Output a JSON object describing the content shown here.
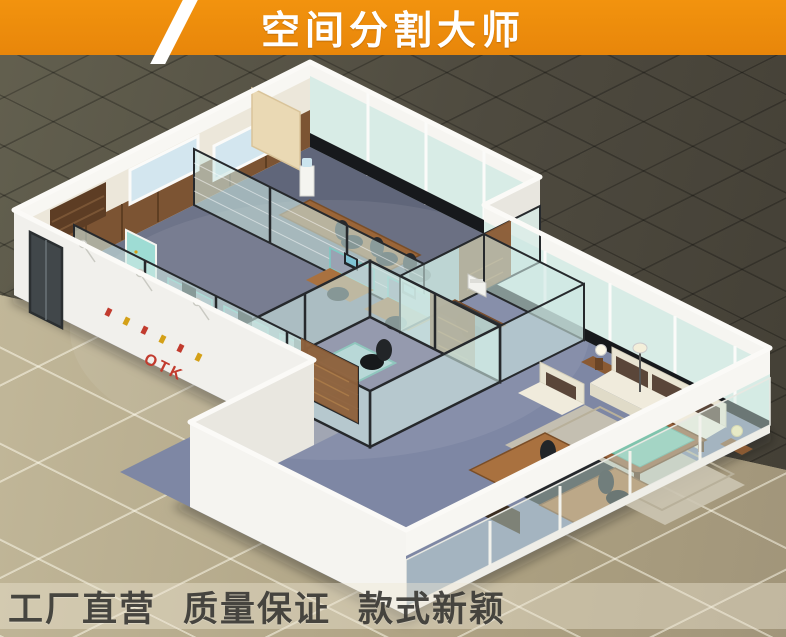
{
  "banner": {
    "title": "空间分割大师"
  },
  "footer": {
    "slogans": [
      "工厂直营",
      "质量保证",
      "款式新颖"
    ]
  },
  "scene": {
    "logo_text": "OTK",
    "description": "isometric 3d render of open-plan office with glass partition walls"
  },
  "colors": {
    "banner_bg": "#F2930E",
    "banner_bg_dark": "#E8860A",
    "banner_text": "#FFFFFF",
    "slash": "#FFFFFF",
    "floor_dark": "#4E4A3F",
    "floor_tan": "#B3A98B",
    "footer_band": "rgba(238,232,212,0.42)",
    "footer_text": "#3B3A36",
    "wall_white": "#F1F0EC",
    "wall_shade": "#E9E7E0",
    "glass": "rgba(205,231,226,0.6)",
    "glass_frosted": "#D8ECE6",
    "glass_frame": "#26292C",
    "wood": "#8A5A33",
    "wood_dark": "#6B4526",
    "carpet": "#79809A",
    "logo_red": "#C23B2E",
    "sofa_cream": "#E9E4D2",
    "sofa_brown": "#5A4639",
    "table_green": "#7FC4AD"
  }
}
